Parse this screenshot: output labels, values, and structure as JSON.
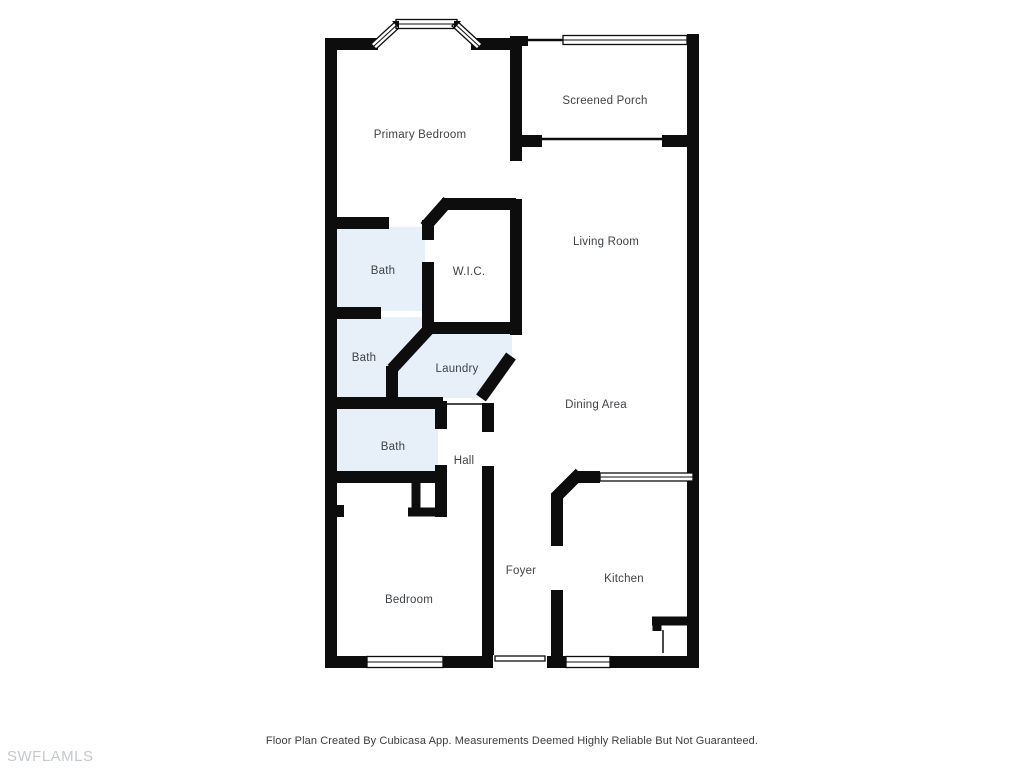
{
  "meta": {
    "footer": "Floor Plan Created By Cubicasa App. Measurements Deemed Highly Reliable But Not Guaranteed.",
    "watermark": "SWFLAMLS"
  },
  "colors": {
    "wall": "#0d0d0d",
    "room_fill_highlight": "#e7f0f9",
    "label_text": "#3f4347",
    "footer_text": "#3c3c3c",
    "watermark_text": "#c5c9cc",
    "background": "#ffffff"
  },
  "rooms": [
    {
      "name": "primary-bedroom",
      "label": "Primary Bedroom",
      "highlighted": false
    },
    {
      "name": "screened-porch",
      "label": "Screened Porch",
      "highlighted": false
    },
    {
      "name": "living-room",
      "label": "Living Room",
      "highlighted": false
    },
    {
      "name": "bath-1",
      "label": "Bath",
      "highlighted": true
    },
    {
      "name": "wic",
      "label": "W.I.C.",
      "highlighted": false
    },
    {
      "name": "bath-2",
      "label": "Bath",
      "highlighted": true
    },
    {
      "name": "laundry",
      "label": "Laundry",
      "highlighted": true
    },
    {
      "name": "dining-area",
      "label": "Dining Area",
      "highlighted": false
    },
    {
      "name": "bath-3",
      "label": "Bath",
      "highlighted": true
    },
    {
      "name": "hall",
      "label": "Hall",
      "highlighted": false
    },
    {
      "name": "foyer",
      "label": "Foyer",
      "highlighted": false
    },
    {
      "name": "kitchen",
      "label": "Kitchen",
      "highlighted": false
    },
    {
      "name": "bedroom",
      "label": "Bedroom",
      "highlighted": false
    }
  ]
}
